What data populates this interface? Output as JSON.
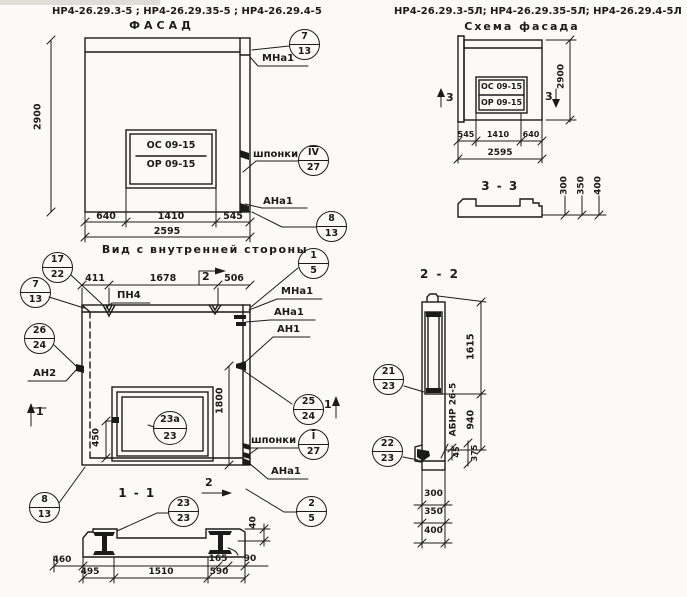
{
  "facade": {
    "codes": "НР4-26.29.3-5 ; НР4-26.29.35-5 ; НР4-26.29.4-5",
    "title": "ФАСАД",
    "window_top": "ОС 09-15",
    "window_bottom": "ОР 09-15",
    "dim_height": "2900",
    "dim_640": "640",
    "dim_1410": "1410",
    "dim_545": "545",
    "dim_total": "2595",
    "label_mna1": "МНа1",
    "label_shponki": "шпонки",
    "label_ana1": "АНа1",
    "callouts": {
      "c7_13": {
        "top": "7",
        "bot": "13"
      },
      "c4_27": {
        "top": "IV",
        "bot": "27"
      },
      "c8_13": {
        "top": "8",
        "bot": "13"
      }
    }
  },
  "scheme": {
    "codes": "НР4-26.29.3-5Л; НР4-26.29.35-5Л; НР4-26.29.4-5Л",
    "title": "Схема фасада",
    "window_top": "ОС 09-15",
    "window_bottom": "ОР 09-15",
    "dim_height": "2900",
    "dim_545": "545",
    "dim_1410": "1410",
    "dim_640": "640",
    "dim_total": "2595",
    "section_mark": "3"
  },
  "section33": {
    "title": "3 - 3",
    "dims": [
      "300",
      "350",
      "400"
    ]
  },
  "inner": {
    "title": "Вид с внутренней стороны",
    "dim_411": "411",
    "dim_1678": "1678",
    "dim_506": "506",
    "dim_450": "450",
    "dim_1800": "1800",
    "label_pn4": "ПН4",
    "label_an2": "АН2",
    "label_mna1": "МНа1",
    "label_ana1": "АНа1",
    "label_an1": "АН1",
    "label_shponki": "шпонки",
    "label_ana1_b": "АНа1",
    "mark_1": "1",
    "mark_2": "2",
    "callouts": {
      "c17_22": {
        "top": "17",
        "bot": "22"
      },
      "c7_13": {
        "top": "7",
        "bot": "13"
      },
      "c26_24": {
        "top": "26",
        "bot": "24"
      },
      "c8_13": {
        "top": "8",
        "bot": "13"
      },
      "c23a_23": {
        "top": "23а",
        "bot": "23"
      },
      "c25_24": {
        "top": "25",
        "bot": "24"
      },
      "c1_27": {
        "top": "I",
        "bot": "27"
      },
      "c1_5": {
        "top": "1",
        "bot": "5"
      },
      "c2_5": {
        "top": "2",
        "bot": "5"
      }
    }
  },
  "section11": {
    "title": "1 - 1",
    "dims": {
      "d460": "460",
      "d495": "495",
      "d1510": "1510",
      "d165": "165",
      "d590": "590",
      "d90": "90",
      "d40": "40"
    },
    "callout": {
      "top": "23",
      "bot": "23"
    }
  },
  "section22": {
    "title": "2 - 2",
    "beam_mark": "АБНР 26-5",
    "dims": {
      "d1615": "1615",
      "d940": "940",
      "d45": "45",
      "d375": "375",
      "d300": "300",
      "d350": "350",
      "d400": "400"
    },
    "callouts": {
      "c21_23": {
        "top": "21",
        "bot": "23"
      },
      "c22_23": {
        "top": "22",
        "bot": "23"
      }
    }
  }
}
